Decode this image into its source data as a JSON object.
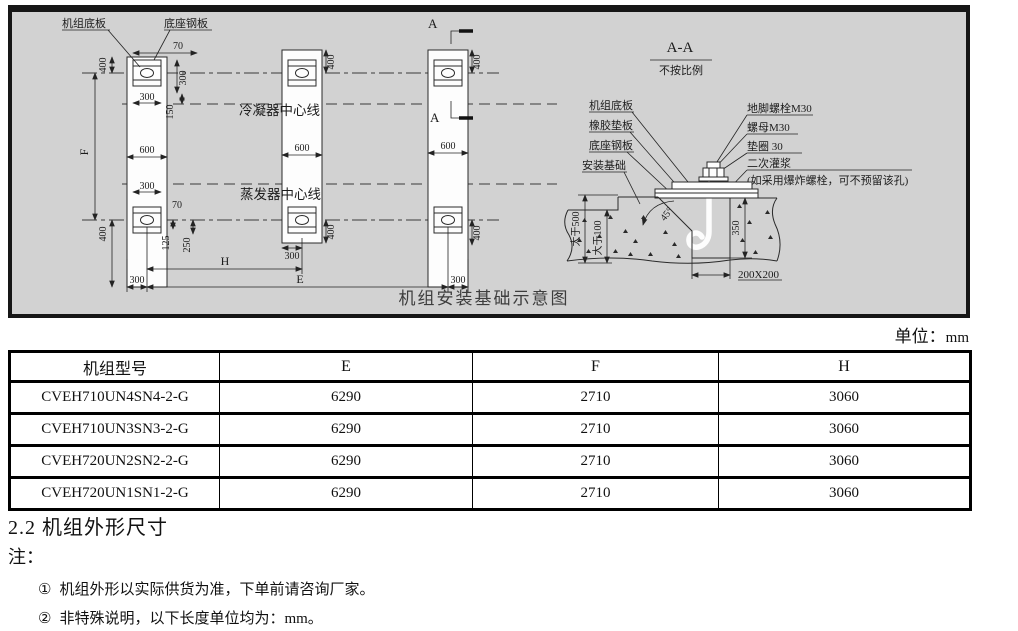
{
  "drawing": {
    "title": "机组安装基础示意图",
    "plan": {
      "labels": {
        "unit_base_plate": "机组底板",
        "base_steel_plate": "底座钢板",
        "condenser_centerline": "冷凝器中心线",
        "evaporator_centerline": "蒸发器中心线"
      },
      "section_mark": "A",
      "dims": {
        "d70": "70",
        "d400": "400",
        "d300": "300",
        "d150": "150",
        "d600": "600",
        "d125": "125",
        "d250": "250",
        "f": "F",
        "h": "H",
        "e": "E"
      }
    },
    "section": {
      "title": "A-A",
      "scale_note": "不按比例",
      "left_labels": {
        "unit_base_plate": "机组底板",
        "rubber_pad": "橡胶垫板",
        "base_steel_plate": "底座钢板",
        "installation_foundation": "安装基础"
      },
      "right_labels": {
        "anchor_bolt": "地脚螺栓M30",
        "nut": "螺母M30",
        "washer": "垫圈  30",
        "secondary_grouting": "二次灌浆",
        "bolt_note": "(如采用爆炸螺栓，可不预留该孔)"
      },
      "dims": {
        "gt500": "大于500",
        "gt100": "大于100",
        "d350": "350",
        "angle": "45°",
        "pocket": "200X200"
      }
    }
  },
  "units_note": {
    "label": "单位：",
    "value": "mm"
  },
  "table": {
    "headers": [
      "机组型号",
      "E",
      "F",
      "H"
    ],
    "rows": [
      [
        "CVEH710UN4SN4-2-G",
        "6290",
        "2710",
        "3060"
      ],
      [
        "CVEH710UN3SN3-2-G",
        "6290",
        "2710",
        "3060"
      ],
      [
        "CVEH720UN2SN2-2-G",
        "6290",
        "2710",
        "3060"
      ],
      [
        "CVEH720UN1SN1-2-G",
        "6290",
        "2710",
        "3060"
      ]
    ]
  },
  "body_text": {
    "section_heading": "2.2 机组外形尺寸",
    "notes_label": "注：",
    "notes": [
      {
        "bullet": "①",
        "text": "机组外形以实际供货为准，下单前请咨询厂家。"
      },
      {
        "bullet": "②",
        "text": "非特殊说明，以下长度单位均为：mm。"
      }
    ]
  }
}
